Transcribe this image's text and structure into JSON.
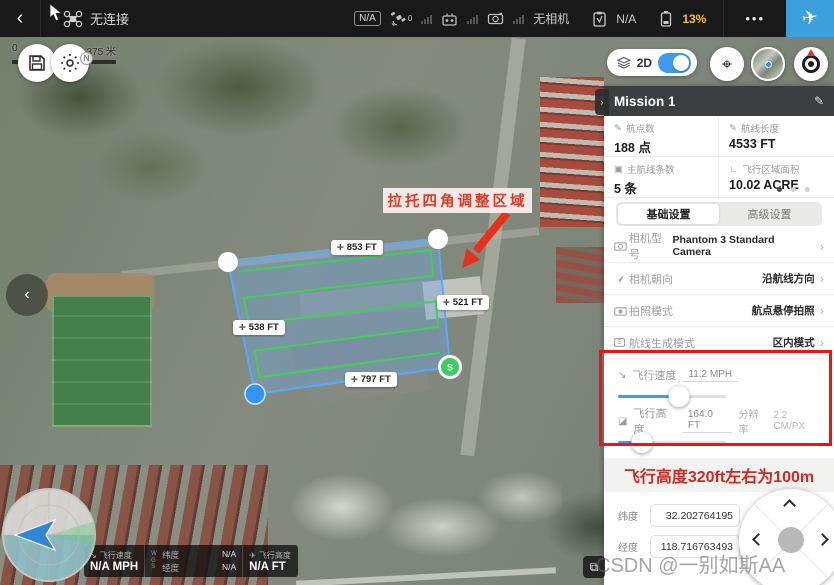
{
  "topbar": {
    "back": "‹",
    "connection_status": "无连接",
    "na_badge": "N/A",
    "satellite_count": "0",
    "camera_status": "无相机",
    "record_status": "N/A",
    "battery": "13%",
    "menu_dots": "•••",
    "fly_icon": "✈"
  },
  "map": {
    "scale_start": "0",
    "scale_end": "375 米",
    "annotation": "拉托四角调整区域",
    "edge_labels": [
      {
        "icon": "✛",
        "text": "853 FT"
      },
      {
        "icon": "✛",
        "text": "521 FT"
      },
      {
        "icon": "✛",
        "text": "538 FT"
      },
      {
        "icon": "✛",
        "text": "797 FT"
      }
    ],
    "start_marker": "S",
    "compass_north": "N"
  },
  "view_controls": {
    "mode_label": "2D",
    "locate_icon": "⌖"
  },
  "panel": {
    "title": "Mission 1",
    "edit_icon": "✎",
    "handle_icon": "›",
    "collapse_icon": "‹",
    "stats": [
      {
        "icon": "✎",
        "label": "航点数",
        "value": "188 点"
      },
      {
        "icon": "✎",
        "label": "航线长度",
        "value": "4533 FT"
      },
      {
        "icon": "▣",
        "label": "主航线条数",
        "value": "5 条"
      },
      {
        "icon": "∟",
        "label": "飞行区域面积",
        "value": "10.02 ACRE"
      }
    ],
    "tabs": [
      {
        "label": "基础设置"
      },
      {
        "label": "高级设置"
      }
    ],
    "chevron": "›",
    "settings": [
      {
        "label": "相机型号",
        "value": "Phantom 3 Standard Camera"
      },
      {
        "label": "相机朝向",
        "value": "沿航线方向"
      },
      {
        "label": "拍照模式",
        "value": "航点悬停拍照"
      },
      {
        "label": "航线生成模式",
        "value": "区内模式"
      }
    ],
    "route_mode_icon": "S",
    "sliders": {
      "speed": {
        "icon": "↘",
        "label": "飞行速度",
        "value": "11.2 MPH",
        "percent": 30
      },
      "altitude": {
        "icon": "◪",
        "label": "飞行高度",
        "value": "164.0 FT",
        "resolution_label": "分辨率",
        "resolution_value": "2.2 CM/PX",
        "percent": 12
      }
    },
    "note": "飞行高度320ft左右为100m",
    "coordinates": {
      "lat_label": "纬度",
      "lat_value": "32.202764195",
      "lng_label": "经度",
      "lng_value": "118.716763493"
    }
  },
  "telemetry": {
    "speed_icon": "↘",
    "speed_label": "飞行速度",
    "speed_value": "N/A MPH",
    "wgs": "WGS",
    "lat_label": "纬度",
    "lat_value": "N/A",
    "lng_label": "经度",
    "lng_value": "N/A",
    "alt_icon": "✈",
    "alt_label": "飞行高度",
    "alt_value": "N/A FT"
  },
  "layers_button_icon": "⧉",
  "watermark": "CSDN @一别如斯AA",
  "colors": {
    "accent_blue": "#3b9cf5",
    "battery_yellow": "#f3c21e",
    "annotation_red": "#e23a2e",
    "polygon_stroke": "#55aaff",
    "route_green": "#3fd24d"
  }
}
